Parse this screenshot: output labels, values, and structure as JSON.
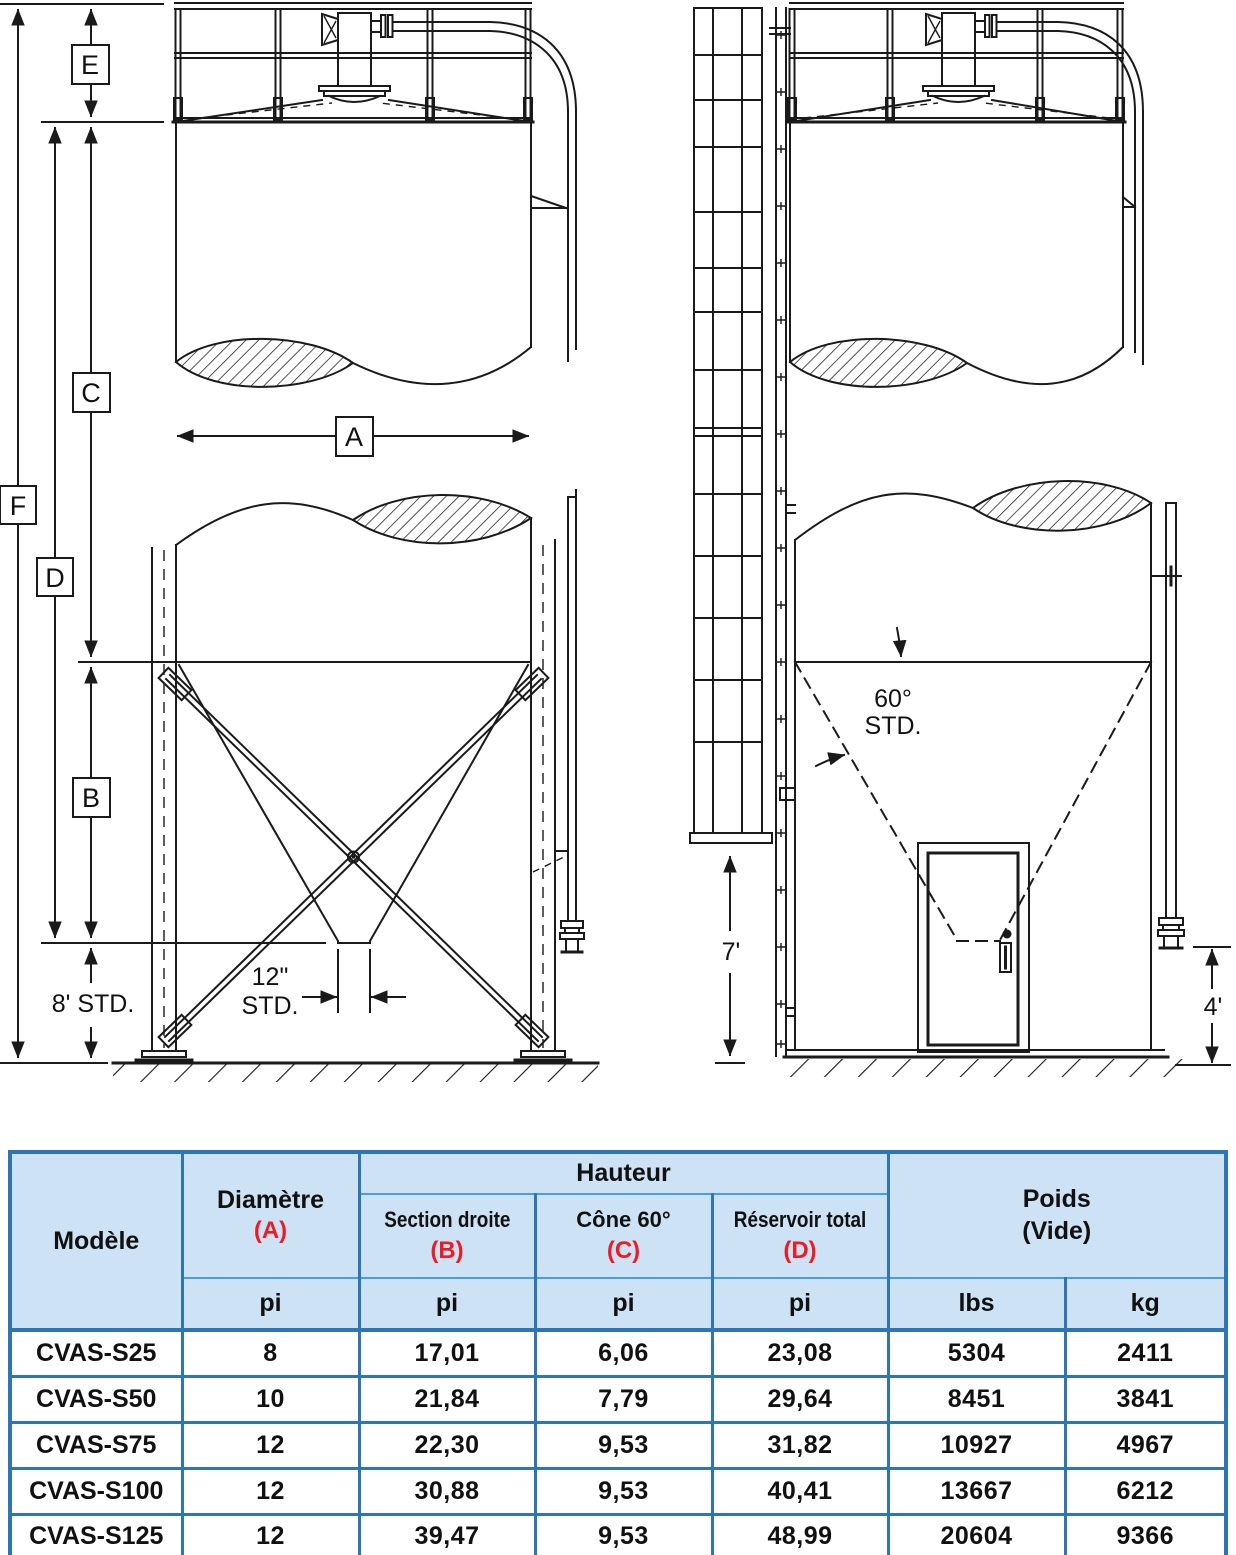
{
  "front": {
    "label_f": "F",
    "label_e": "E",
    "label_d": "D",
    "label_c": "C",
    "label_b": "B",
    "label_a": "A",
    "skirt_note": "8' STD.",
    "outlet_note_1": "12\"",
    "outlet_note_2": "STD."
  },
  "side": {
    "cone_note_1": "60°",
    "cone_note_2": "STD.",
    "ladder_dim": "7'",
    "pipe_dim": "4'"
  },
  "table": {
    "headers": {
      "model": "Modèle",
      "diameter": "Diamètre",
      "diameter_ref": "(A)",
      "height_group": "Hauteur",
      "straight": "Section droite",
      "straight_ref": "(B)",
      "cone": "Cône 60°",
      "cone_ref": "(C)",
      "total": "Réservoir total",
      "total_ref": "(D)",
      "weight_1": "Poids",
      "weight_2": "(Vide)"
    },
    "units": {
      "diameter": "pi",
      "straight": "pi",
      "cone": "pi",
      "total": "pi",
      "pounds": "lbs",
      "kilograms": "kg"
    },
    "rows": [
      {
        "model": "CVAS-S25",
        "diameter": "8",
        "straight": "17,01",
        "cone": "6,06",
        "total": "23,08",
        "lbs": "5304",
        "kg": "2411"
      },
      {
        "model": "CVAS-S50",
        "diameter": "10",
        "straight": "21,84",
        "cone": "7,79",
        "total": "29,64",
        "lbs": "8451",
        "kg": "3841"
      },
      {
        "model": "CVAS-S75",
        "diameter": "12",
        "straight": "22,30",
        "cone": "9,53",
        "total": "31,82",
        "lbs": "10927",
        "kg": "4967"
      },
      {
        "model": "CVAS-S100",
        "diameter": "12",
        "straight": "30,88",
        "cone": "9,53",
        "total": "40,41",
        "lbs": "13667",
        "kg": "6212"
      },
      {
        "model": "CVAS-S125",
        "diameter": "12",
        "straight": "39,47",
        "cone": "9,53",
        "total": "48,99",
        "lbs": "20604",
        "kg": "9366"
      }
    ]
  },
  "colors": {
    "grid_blue": "#2e75b6",
    "thin_blue": "#45a1dd",
    "header_bg": "#cde2f4",
    "model_blue": "#2e75b6",
    "ref_red": "#ec1b24",
    "ink": "#1a1a1a"
  }
}
